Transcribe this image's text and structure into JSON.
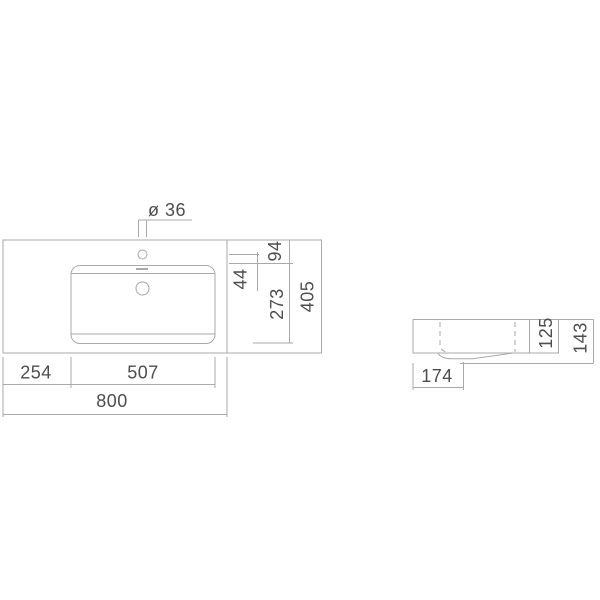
{
  "colors": {
    "line": "#a9a9a9",
    "text": "#4d4d4d",
    "background": "#ffffff"
  },
  "plan_view": {
    "labels": {
      "faucet_hole_diameter": "ø 36",
      "back_edge_to_bowl": "94",
      "faucet_center_to_bowl": "44",
      "bowl_front_to_back": "273",
      "overall_depth": "405",
      "left_edge_to_bowl": "254",
      "bowl_width": "507",
      "overall_width": "800"
    }
  },
  "side_view": {
    "labels": {
      "front_to_drain": "174",
      "body_height": "125",
      "overall_height": "143"
    }
  }
}
